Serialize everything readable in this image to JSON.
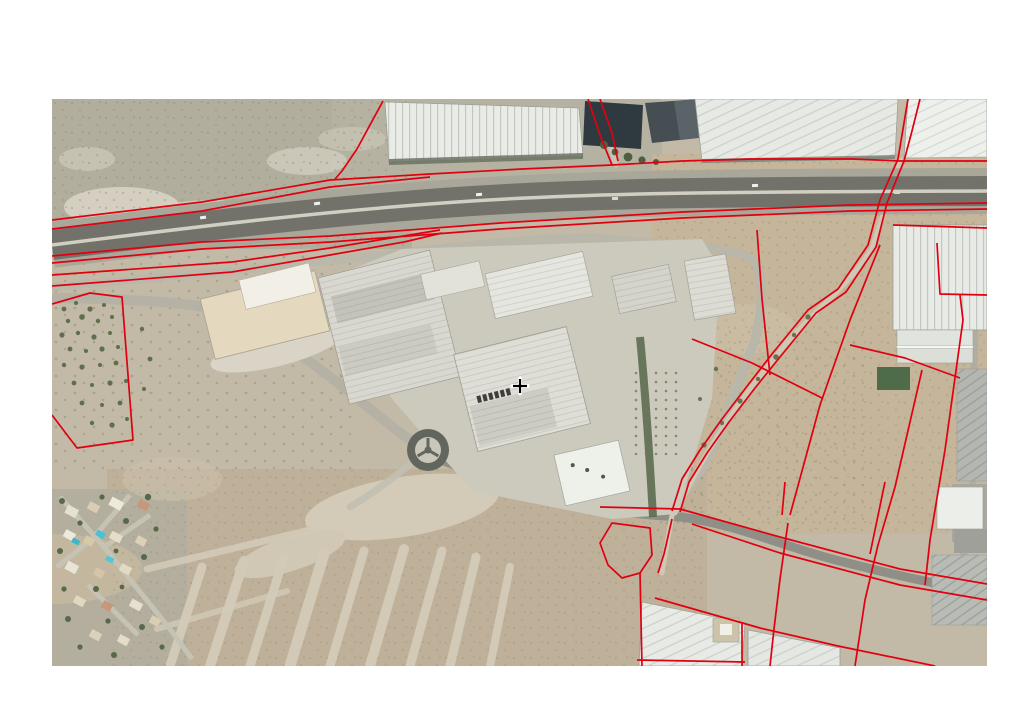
{
  "page": {
    "background_color": "#ffffff"
  },
  "map": {
    "kind": "aerial-orthophoto-with-cadastral-overlay",
    "frame": {
      "left_px": 52,
      "top_px": 99,
      "width_px": 935,
      "height_px": 567
    },
    "features": [
      "motorway-corridor",
      "service-roads",
      "greenhouse-complexes",
      "irrigation-pond",
      "industrial-estate-warehouses",
      "roundabout",
      "olive-grove",
      "residential-area",
      "undeveloped-plot-grid",
      "farm-track",
      "fields",
      "cadastral-parcel-boundaries"
    ],
    "palette": {
      "scrub": "#b2ae9d",
      "fields": "#c4b59b",
      "estate_ground": "#cbc8bc",
      "highway_pavement": "#72726b",
      "greenhouse_roof": "#e9ebe6",
      "pond": "#2f3a40",
      "vegetation": "#5f6f4b"
    },
    "cursor": {
      "type": "crosshair",
      "x": 468,
      "y": 287,
      "color": "#000000",
      "halo_color": "#ffffff"
    },
    "overlay": {
      "stroke_color": "#e10010",
      "stroke_width": 1.7,
      "parcel_lines": [
        {
          "id": "hwy-north-a",
          "closed": false,
          "points": [
            [
              0,
              121
            ],
            [
              150,
              103
            ],
            [
              278,
              81
            ],
            [
              378,
              75
            ],
            [
              470,
              70
            ],
            [
              560,
              66
            ],
            [
              630,
              62
            ],
            [
              700,
              60
            ],
            [
              800,
              60
            ],
            [
              848,
              62
            ],
            [
              935,
              62
            ]
          ]
        },
        {
          "id": "hwy-north-b",
          "closed": false,
          "points": [
            [
              0,
              130
            ],
            [
              150,
              112
            ],
            [
              278,
              88
            ],
            [
              378,
              78
            ]
          ]
        },
        {
          "id": "hwy-south-a",
          "closed": false,
          "points": [
            [
              0,
              157
            ],
            [
              150,
              143
            ],
            [
              278,
              137
            ],
            [
              448,
              124
            ],
            [
              630,
              113
            ],
            [
              798,
              106
            ],
            [
              935,
              104
            ]
          ]
        },
        {
          "id": "hwy-south-b",
          "closed": false,
          "points": [
            [
              0,
              164
            ],
            [
              150,
              150
            ],
            [
              278,
              143
            ],
            [
              448,
              130
            ],
            [
              630,
              119
            ],
            [
              798,
              112
            ],
            [
              935,
              110
            ]
          ]
        },
        {
          "id": "wedge-a",
          "closed": false,
          "points": [
            [
              0,
              176
            ],
            [
              180,
              163
            ],
            [
              278,
              149
            ],
            [
              388,
              131
            ]
          ]
        },
        {
          "id": "wedge-b",
          "closed": false,
          "points": [
            [
              0,
              187
            ],
            [
              180,
              173
            ],
            [
              278,
              156
            ],
            [
              352,
              143
            ],
            [
              390,
              134
            ]
          ]
        },
        {
          "id": "greenhouse-west-boundary",
          "closed": false,
          "points": [
            [
              331,
              2
            ],
            [
              305,
              50
            ],
            [
              290,
              72
            ],
            [
              283,
              80
            ]
          ]
        },
        {
          "id": "pond-track-a",
          "closed": false,
          "points": [
            [
              536,
              0
            ],
            [
              548,
              36
            ],
            [
              560,
              66
            ]
          ]
        },
        {
          "id": "pond-track-b",
          "closed": false,
          "points": [
            [
              548,
              0
            ],
            [
              560,
              34
            ],
            [
              566,
              62
            ]
          ]
        },
        {
          "id": "top-right-track-a",
          "closed": false,
          "points": [
            [
              856,
              0
            ],
            [
              851,
              30
            ],
            [
              846,
              60
            ]
          ]
        },
        {
          "id": "top-right-track-b",
          "closed": false,
          "points": [
            [
              868,
              0
            ],
            [
              860,
              32
            ],
            [
              852,
              62
            ]
          ]
        },
        {
          "id": "camino-west",
          "closed": false,
          "points": [
            [
              846,
              60
            ],
            [
              828,
              101
            ],
            [
              816,
              146
            ],
            [
              786,
              190
            ],
            [
              756,
              211
            ],
            [
              720,
              255
            ],
            [
              696,
              286
            ],
            [
              670,
              320
            ],
            [
              648,
              351
            ],
            [
              630,
              380
            ],
            [
              620,
              412
            ]
          ]
        },
        {
          "id": "camino-east",
          "closed": false,
          "points": [
            [
              852,
              62
            ],
            [
              835,
              104
            ],
            [
              824,
              148
            ],
            [
              794,
              193
            ],
            [
              764,
              214
            ],
            [
              728,
              258
            ],
            [
              703,
              289
            ],
            [
              677,
              323
            ],
            [
              655,
              354
            ],
            [
              637,
              383
            ],
            [
              628,
              413
            ]
          ]
        },
        {
          "id": "camino-south",
          "closed": false,
          "points": [
            [
              620,
              420
            ],
            [
              612,
              455
            ],
            [
              606,
              474
            ]
          ]
        },
        {
          "id": "parcel-diag-east",
          "closed": false,
          "points": [
            [
              828,
              146
            ],
            [
              798,
              221
            ],
            [
              768,
              306
            ],
            [
              738,
              416
            ]
          ]
        },
        {
          "id": "parcel-diag-east-south",
          "closed": false,
          "points": [
            [
              736,
              424
            ],
            [
              728,
              480
            ],
            [
              722,
              530
            ],
            [
              718,
              567
            ]
          ]
        },
        {
          "id": "parcel-right-road",
          "closed": false,
          "points": [
            [
              908,
              196
            ],
            [
              911,
              221
            ],
            [
              893,
              351
            ],
            [
              878,
              441
            ],
            [
              873,
              486
            ]
          ]
        },
        {
          "id": "parcel-r5",
          "closed": false,
          "points": [
            [
              870,
              271
            ],
            [
              843,
              388
            ],
            [
              826,
              446
            ],
            [
              813,
              501
            ],
            [
              803,
              567
            ]
          ]
        },
        {
          "id": "parcel-cross",
          "closed": false,
          "points": [
            [
              798,
              246
            ],
            [
              853,
              259
            ],
            [
              908,
              279
            ]
          ]
        },
        {
          "id": "field-top-right",
          "closed": false,
          "points": [
            [
              885,
              144
            ],
            [
              888,
              195
            ],
            [
              935,
              196
            ]
          ]
        },
        {
          "id": "greenhouse-right-top",
          "closed": false,
          "points": [
            [
              841,
              126
            ],
            [
              935,
              129
            ]
          ]
        },
        {
          "id": "field-v1",
          "closed": false,
          "points": [
            [
              705,
              131
            ],
            [
              710,
              200
            ],
            [
              718,
              276
            ]
          ]
        },
        {
          "id": "field-h1",
          "closed": false,
          "points": [
            [
              640,
              240
            ],
            [
              700,
              264
            ],
            [
              770,
              299
            ]
          ]
        },
        {
          "id": "road-north-border",
          "closed": false,
          "points": [
            [
              548,
              408
            ],
            [
              628,
              410
            ],
            [
              728,
              438
            ],
            [
              848,
              470
            ],
            [
              935,
              485
            ]
          ]
        },
        {
          "id": "road-south-border",
          "closed": false,
          "points": [
            [
              640,
              425
            ],
            [
              728,
              454
            ],
            [
              848,
              486
            ],
            [
              935,
              501
            ]
          ]
        },
        {
          "id": "round-parcel",
          "closed": true,
          "points": [
            [
              560,
              424
            ],
            [
              548,
              444
            ],
            [
              556,
              466
            ],
            [
              570,
              479
            ],
            [
              588,
              474
            ],
            [
              600,
              456
            ],
            [
              598,
              429
            ]
          ]
        },
        {
          "id": "greenhouse-bottom-top-edge",
          "closed": false,
          "points": [
            [
              603,
              499
            ],
            [
              708,
              529
            ],
            [
              786,
              547
            ],
            [
              883,
              567
            ]
          ]
        },
        {
          "id": "greenhouse-bottom-v1",
          "closed": false,
          "points": [
            [
              588,
              474
            ],
            [
              590,
              567
            ]
          ]
        },
        {
          "id": "greenhouse-bottom-v2",
          "closed": false,
          "points": [
            [
              690,
              523
            ],
            [
              690,
              567
            ]
          ]
        },
        {
          "id": "greenhouse-bottom-h1",
          "closed": false,
          "points": [
            [
              585,
              561
            ],
            [
              693,
              563
            ]
          ]
        },
        {
          "id": "field-v2",
          "closed": false,
          "points": [
            [
              833,
              383
            ],
            [
              818,
              455
            ]
          ]
        },
        {
          "id": "field-v3",
          "closed": false,
          "points": [
            [
              733,
              383
            ],
            [
              730,
              416
            ]
          ]
        },
        {
          "id": "olive-parcel",
          "closed": false,
          "points": [
            [
              0,
              205
            ],
            [
              38,
              194
            ],
            [
              70,
              198
            ],
            [
              81,
              341
            ],
            [
              25,
              349
            ],
            [
              0,
              316
            ]
          ]
        }
      ]
    }
  }
}
